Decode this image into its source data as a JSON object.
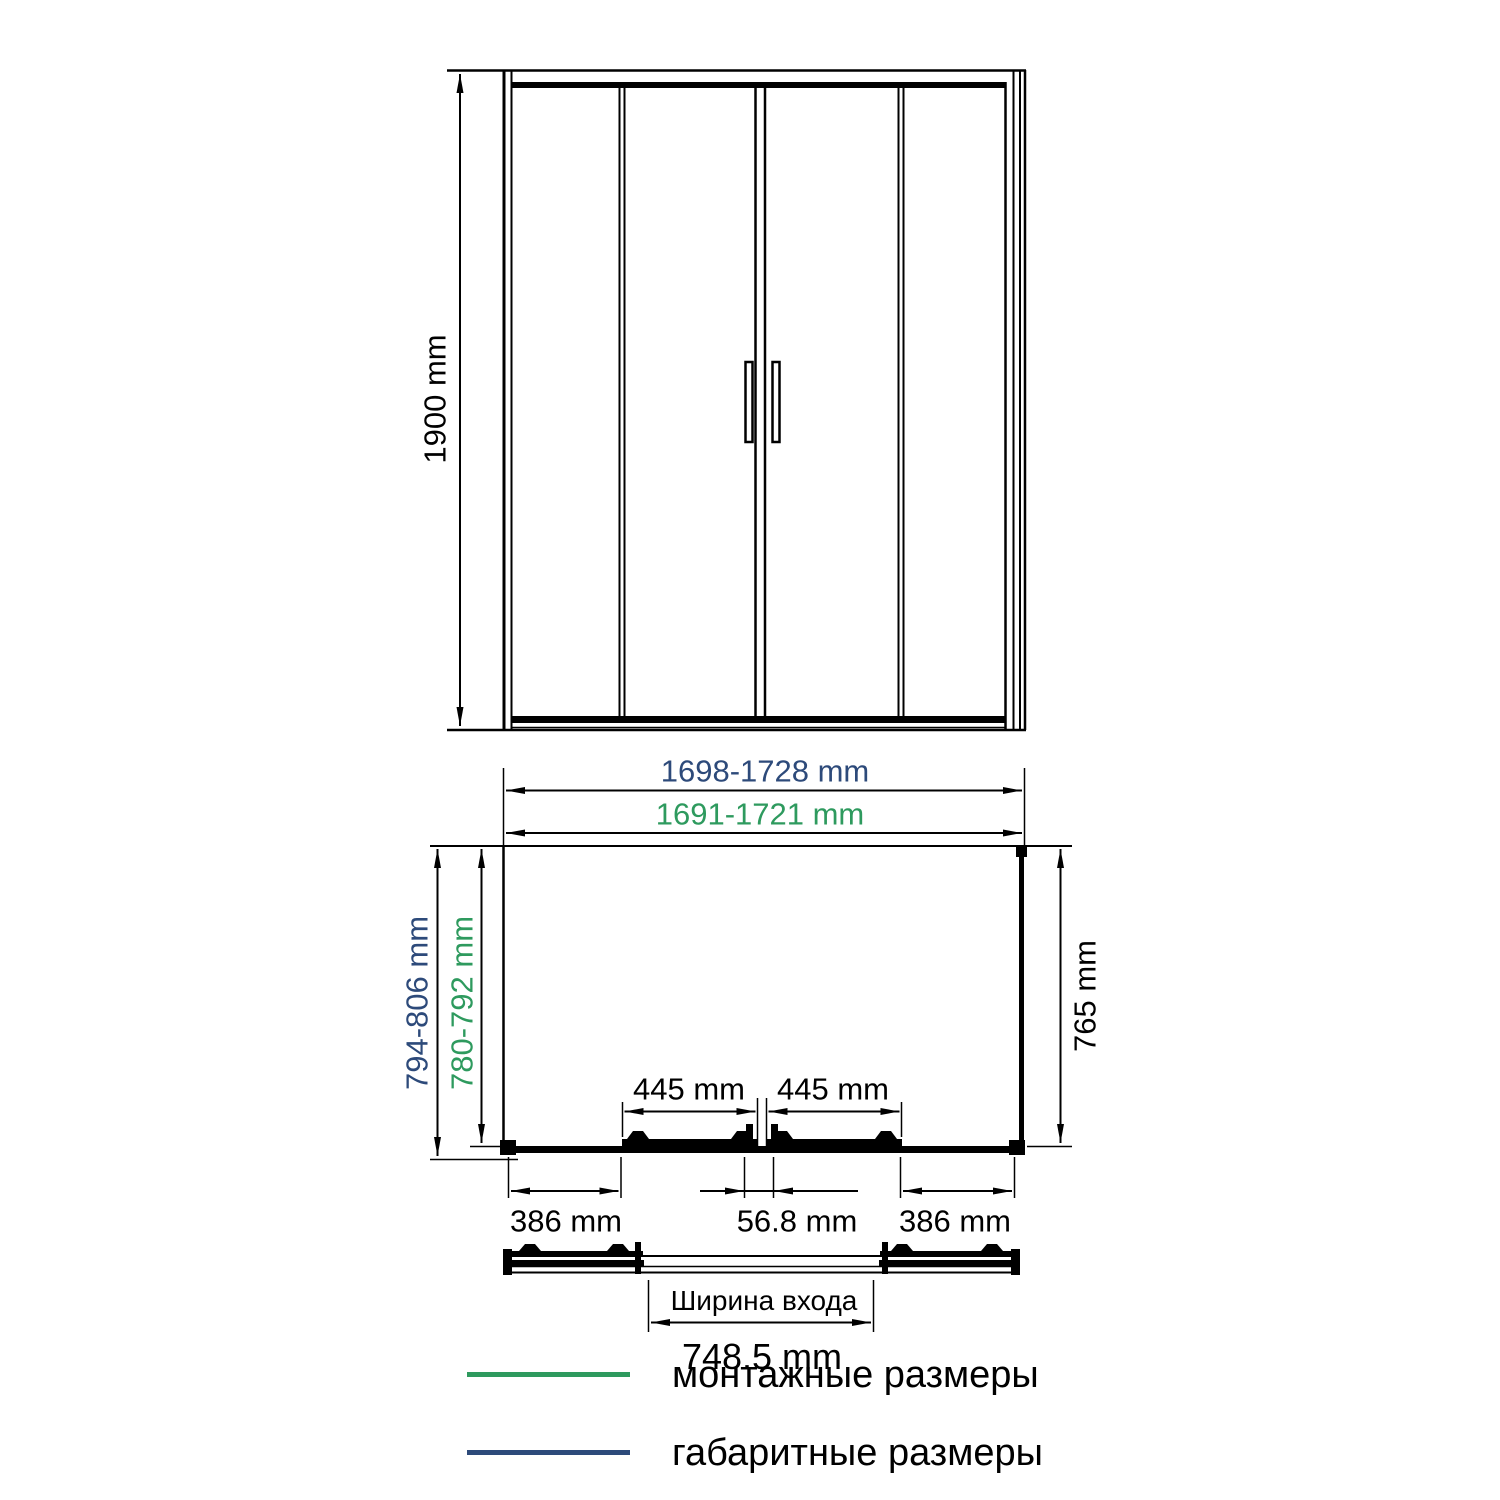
{
  "drawing_title": "shower-enclosure-dimension-diagram",
  "colors": {
    "install_dimension_green": "#2e9a5e",
    "overall_dimension_navy": "#2d4a7a",
    "line_black": "#000000",
    "background": "#ffffff"
  },
  "front_view": {
    "height": "1900 mm"
  },
  "plan": {
    "overall_width": "1698-1728 mm",
    "install_width": "1691-1721 mm",
    "overall_depth": "794-806 mm",
    "install_depth": "780-792 mm",
    "side_depth": "765 mm",
    "door_left": "445 mm",
    "door_right": "445 mm",
    "panel_left": "386 mm",
    "center_overlap": "56.8 mm",
    "panel_right": "386 mm"
  },
  "entrance": {
    "label": "Ширина входа",
    "width": "748.5 mm"
  },
  "legend": {
    "items": [
      {
        "label": "монтажные размеры",
        "color": "#2e9a5e"
      },
      {
        "label": "габаритные размеры",
        "color": "#2d4a7a"
      }
    ]
  }
}
